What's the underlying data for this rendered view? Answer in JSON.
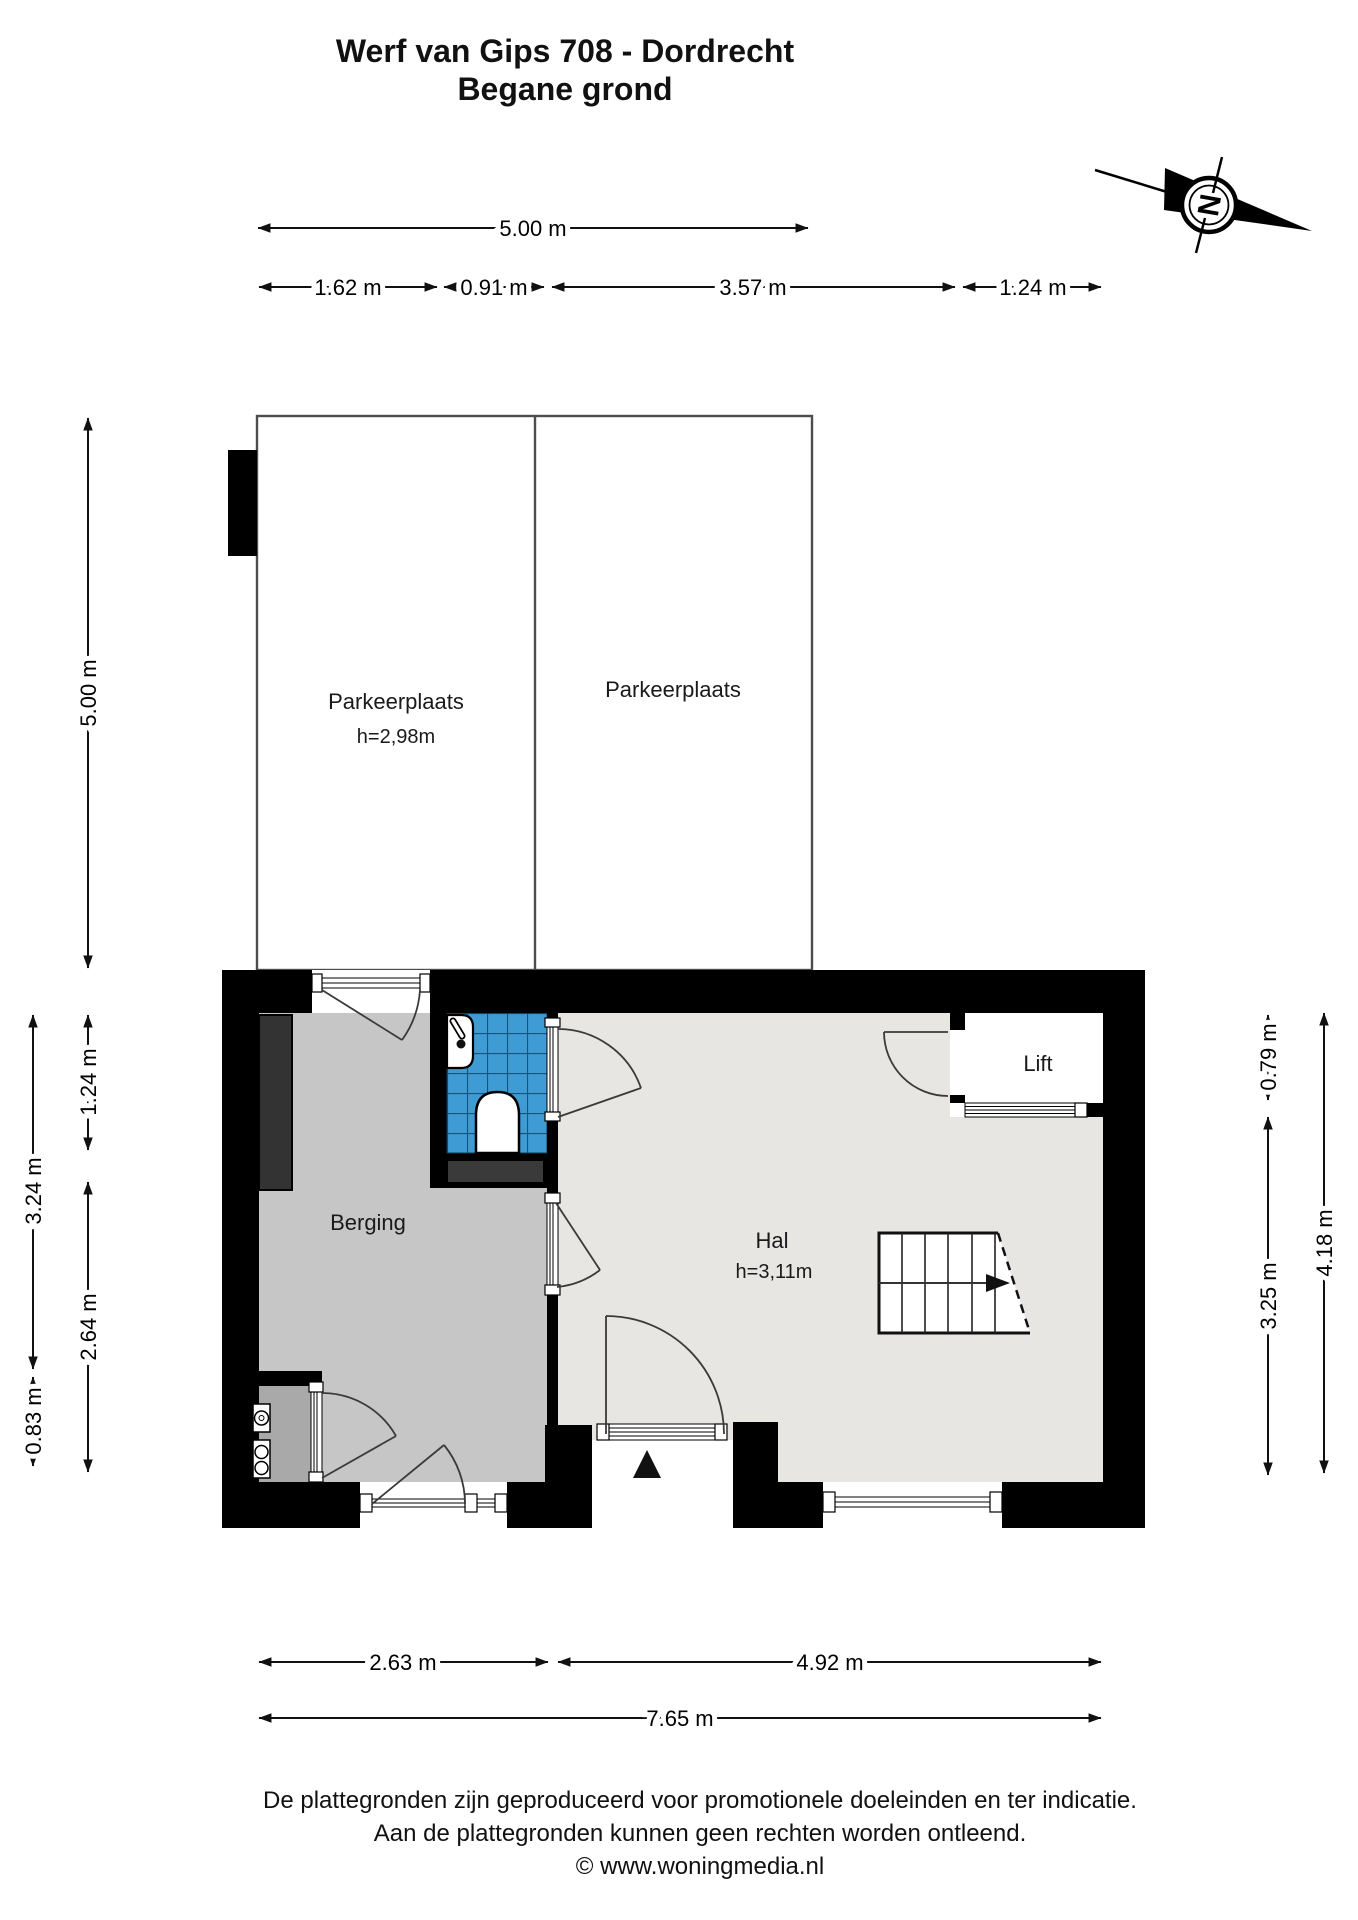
{
  "title": {
    "line1": "Werf van Gips 708 - Dordrecht",
    "line2": "Begane grond"
  },
  "compass": {
    "label": "N"
  },
  "rooms": {
    "parking_left": {
      "name": "Parkeerplaats",
      "height": "h=2,98m"
    },
    "parking_right": {
      "name": "Parkeerplaats"
    },
    "berging": {
      "name": "Berging"
    },
    "hal": {
      "name": "Hal",
      "height": "h=3,11m"
    },
    "lift": {
      "name": "Lift"
    }
  },
  "dims": {
    "top_total": "5.00 m",
    "top_1": "1.62 m",
    "top_2": "0.91 m",
    "top_3": "3.57 m",
    "top_4": "1.24 m",
    "left_total": "5.00 m",
    "left_outer_1": "3.24 m",
    "left_outer_2": "0.83 m",
    "left_1": "1.24 m",
    "left_2": "2.64 m",
    "right_1": "0.79 m",
    "right_2": "3.25 m",
    "right_outer": "4.18 m",
    "bottom_1": "2.63 m",
    "bottom_2": "4.92 m",
    "bottom_total": "7.65 m"
  },
  "footer": {
    "line1": "De plattegronden zijn geproduceerd voor promotionele doeleinden en ter indicatie.",
    "line2": "Aan de plattegronden kunnen geen rechten worden ontleend.",
    "line3": "© www.woningmedia.nl"
  },
  "colors": {
    "wall": "#000000",
    "parking_floor": "#e9e9e9",
    "berging_floor": "#c6c6c6",
    "meterkast_floor": "#a9a9a9",
    "hal_floor": "#e7e6e2",
    "lift_floor": "#ffffff",
    "tile_blue": "#3f9bd3",
    "tile_grid": "#14557e",
    "fixture_dark": "#3a3a3a"
  }
}
